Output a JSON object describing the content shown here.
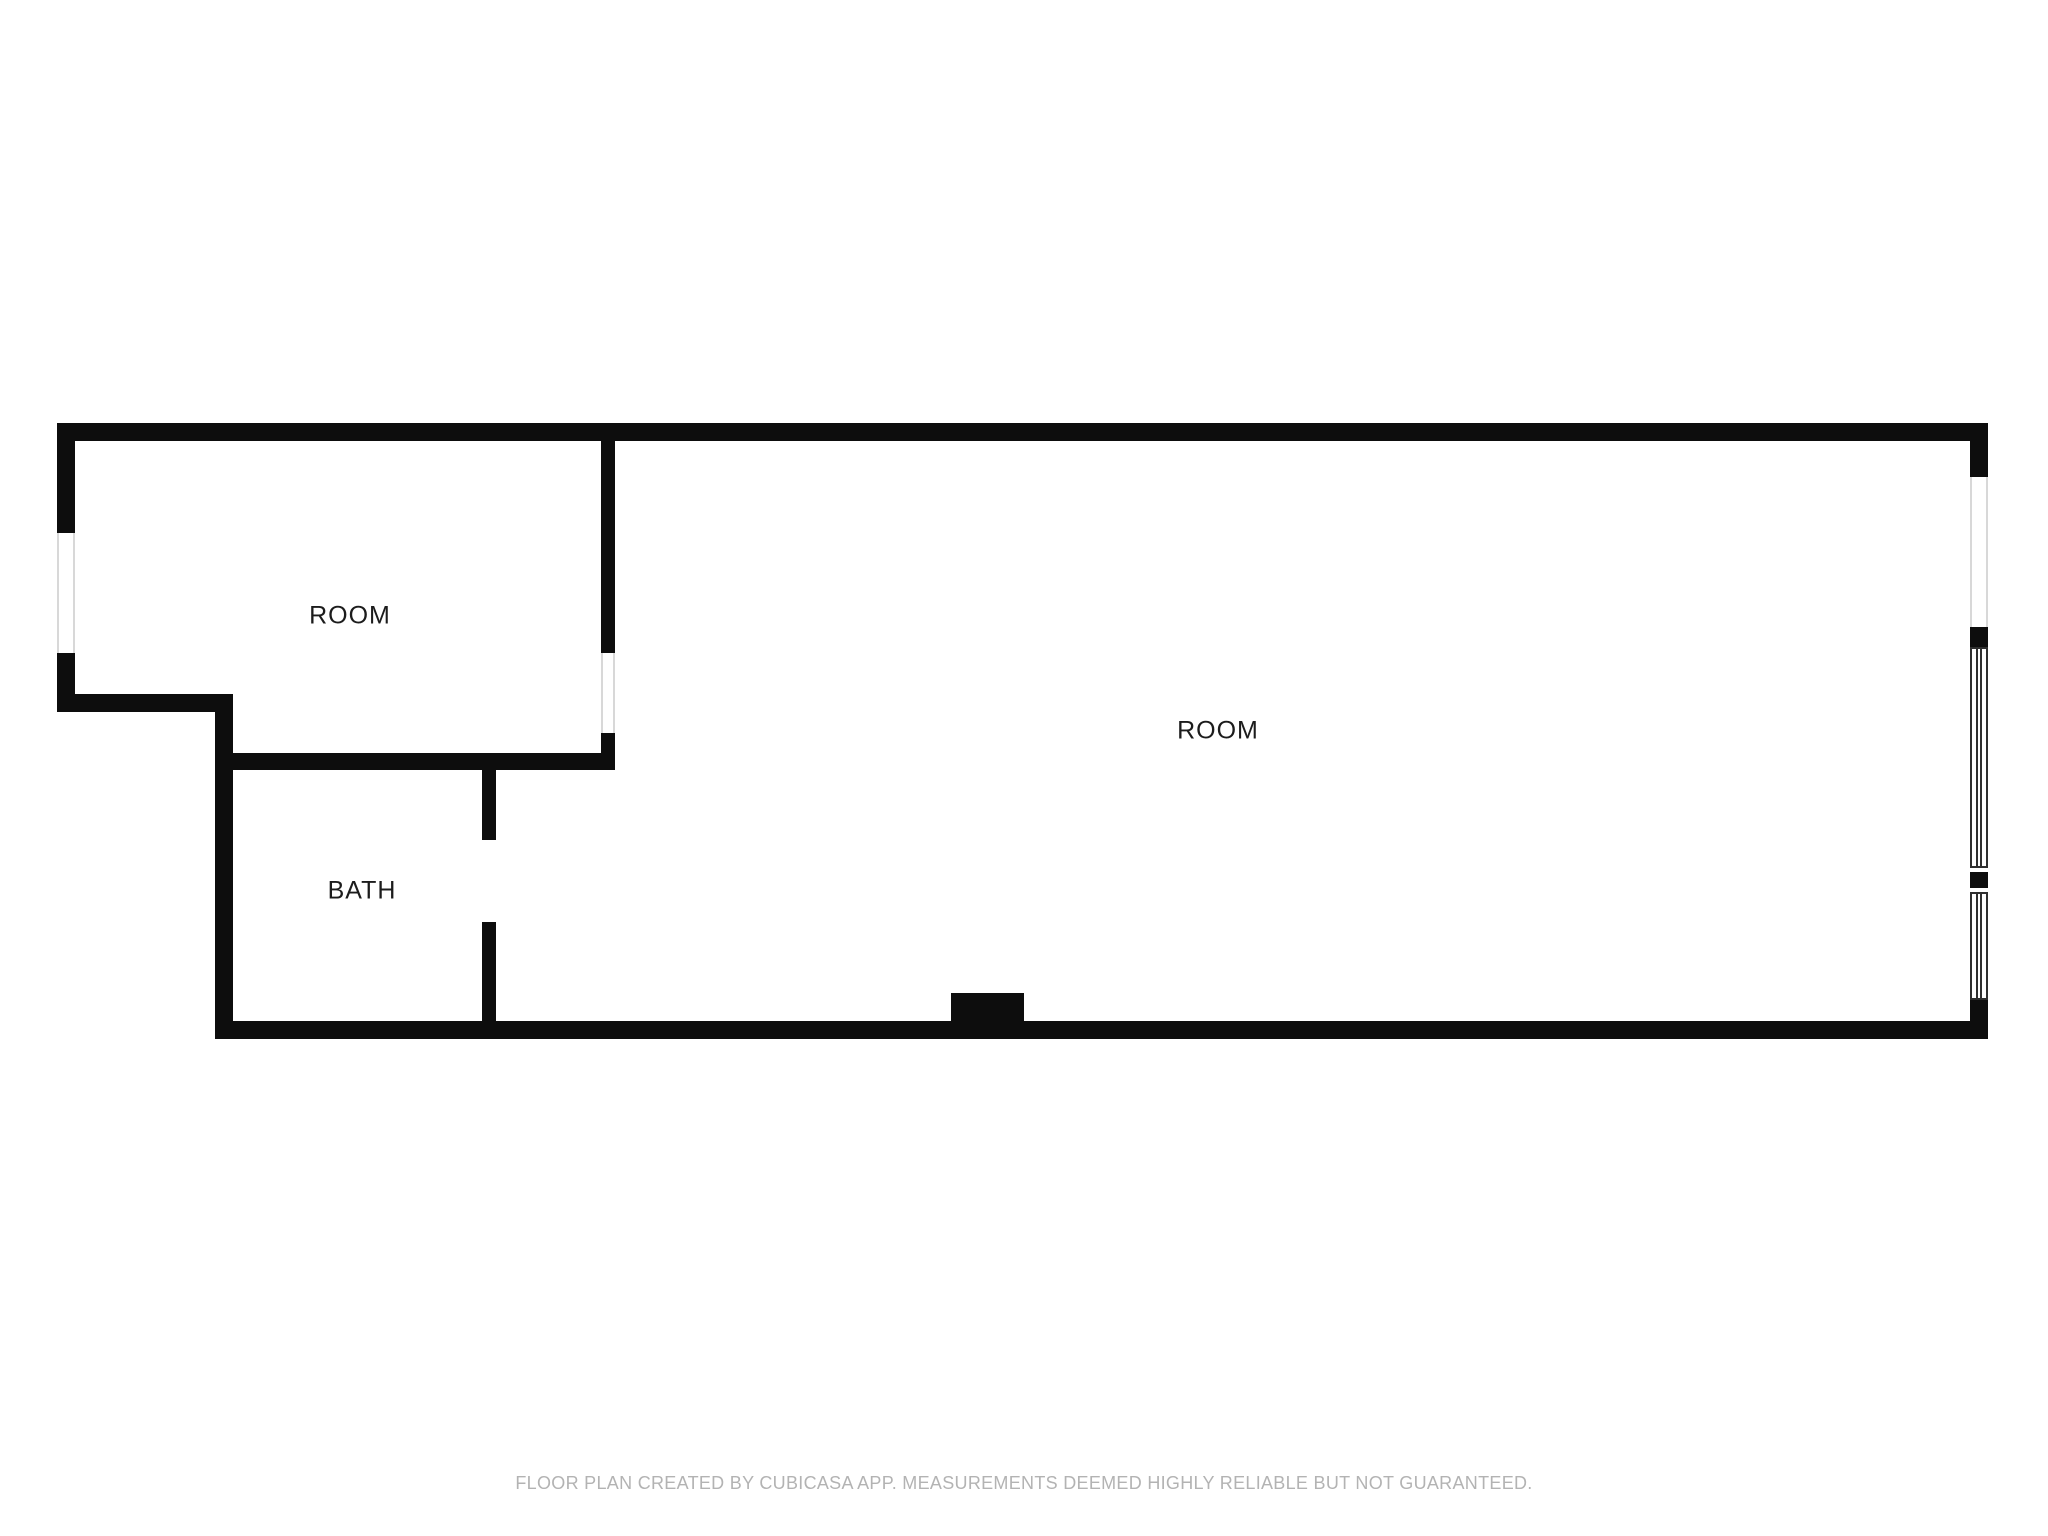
{
  "meta": {
    "title": "Floor plan",
    "creator_note_visible": true
  },
  "colors": {
    "background": "#ffffff",
    "wall": "#0d0d0d",
    "label_text": "#1c1c1c",
    "footer_text": "#b3b3b3",
    "window_light_line": "#d8d8d8",
    "window_frame": "#2f2f2f"
  },
  "rooms": [
    {
      "name": "room-1",
      "label": "ROOM",
      "cx": 350,
      "cy": 616
    },
    {
      "name": "bath",
      "label": "BATH",
      "cx": 362,
      "cy": 891
    },
    {
      "name": "room-2",
      "label": "ROOM",
      "cx": 1218,
      "cy": 731
    }
  ],
  "footer": {
    "text": "FLOOR PLAN CREATED BY CUBICASA APP. MEASUREMENTS DEEMED HIGHLY RELIABLE BUT NOT GUARANTEED."
  },
  "plan": {
    "walls": [
      {
        "name": "top-wall",
        "x": 57,
        "y": 423,
        "w": 1931,
        "h": 18
      },
      {
        "name": "left-wall-upper",
        "x": 57,
        "y": 423,
        "w": 18,
        "h": 110
      },
      {
        "name": "left-wall-lower",
        "x": 57,
        "y": 653,
        "w": 18,
        "h": 59
      },
      {
        "name": "jog-wall",
        "x": 57,
        "y": 694,
        "w": 176,
        "h": 18
      },
      {
        "name": "bath-left-wall",
        "x": 215,
        "y": 712,
        "w": 18,
        "h": 327
      },
      {
        "name": "bottom-wall",
        "x": 215,
        "y": 1021,
        "w": 1773,
        "h": 18
      },
      {
        "name": "room-bath-divider",
        "x": 215,
        "y": 753,
        "w": 400,
        "h": 17
      },
      {
        "name": "bath-right-wall-upper",
        "x": 482,
        "y": 770,
        "w": 14,
        "h": 70
      },
      {
        "name": "bath-right-wall-lower",
        "x": 482,
        "y": 922,
        "w": 14,
        "h": 99
      },
      {
        "name": "interior-wall-upper",
        "x": 601,
        "y": 441,
        "w": 14,
        "h": 212
      },
      {
        "name": "interior-wall-lower",
        "x": 601,
        "y": 733,
        "w": 14,
        "h": 37
      },
      {
        "name": "right-wall-top",
        "x": 1970,
        "y": 423,
        "w": 18,
        "h": 54
      },
      {
        "name": "right-wall-mid-1",
        "x": 1970,
        "y": 627,
        "w": 18,
        "h": 20
      },
      {
        "name": "right-wall-mid-2",
        "x": 1970,
        "y": 872,
        "w": 18,
        "h": 16
      },
      {
        "name": "right-wall-bottom",
        "x": 1970,
        "y": 1000,
        "w": 18,
        "h": 39
      },
      {
        "name": "entry-threshold",
        "x": 951,
        "y": 993,
        "w": 73,
        "h": 28
      }
    ],
    "openings": [
      {
        "name": "left-wall-window",
        "x": 57,
        "y": 533,
        "w": 18,
        "h": 120
      },
      {
        "name": "interior-wall-opening",
        "x": 601,
        "y": 653,
        "w": 14,
        "h": 80
      },
      {
        "name": "right-wall-opening",
        "x": 1970,
        "y": 477,
        "w": 18,
        "h": 150
      }
    ],
    "windows": [
      {
        "name": "right-wall-window-1",
        "x": 1970,
        "y": 647,
        "w": 18,
        "h": 221
      },
      {
        "name": "right-wall-window-2",
        "x": 1970,
        "y": 892,
        "w": 18,
        "h": 108
      }
    ],
    "door_gaps": [
      {
        "name": "bath-door-opening",
        "x": 482,
        "y": 840,
        "w": 14,
        "h": 82
      }
    ]
  }
}
